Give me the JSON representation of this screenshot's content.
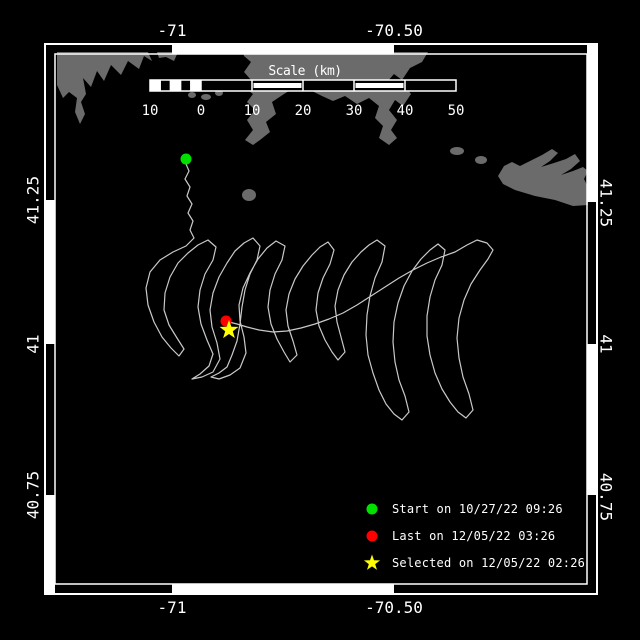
{
  "colors": {
    "background": "#000000",
    "frame": "#ffffff",
    "land": "#6b6b6b",
    "track": "#c9c9c9",
    "text": "#ffffff",
    "start_marker": "#00e100",
    "last_marker": "#ff0000",
    "selected_marker": "#ffff00"
  },
  "axis_labels": {
    "top": [
      {
        "text": "-71",
        "x": 172
      },
      {
        "text": "-70.50",
        "x": 394
      }
    ],
    "bottom": [
      {
        "text": "-71",
        "x": 172
      },
      {
        "text": "-70.50",
        "x": 394
      }
    ],
    "left": [
      {
        "text": "41.25",
        "y": 200
      },
      {
        "text": "41",
        "y": 344
      },
      {
        "text": "40.75",
        "y": 495
      }
    ],
    "right": [
      {
        "text": "41.25",
        "y": 203
      },
      {
        "text": "41",
        "y": 344
      },
      {
        "text": "40.75",
        "y": 497
      }
    ]
  },
  "frame": {
    "outer": [
      45,
      44,
      597,
      594
    ],
    "band": 10,
    "top_fill": [
      [
        172,
        394
      ]
    ],
    "bottom_fill": [
      [
        172,
        394
      ]
    ],
    "left_fill": [
      [
        200,
        344
      ],
      [
        495,
        594
      ]
    ],
    "right_fill": [
      [
        44,
        202
      ],
      [
        344,
        495
      ]
    ]
  },
  "scale_bar": {
    "title": "Scale (km)",
    "title_x": 305,
    "title_y": 64,
    "x0": 150,
    "x1": 456,
    "y": 80,
    "h": 11,
    "zero_x": 201,
    "labels": [
      {
        "text": "10",
        "x": 150
      },
      {
        "text": "0",
        "x": 201
      },
      {
        "text": "10",
        "x": 252
      },
      {
        "text": "20",
        "x": 303
      },
      {
        "text": "30",
        "x": 354
      },
      {
        "text": "40",
        "x": 405
      },
      {
        "text": "50",
        "x": 456
      }
    ],
    "label_y": 103,
    "sub_white": [
      [
        150.0,
        160.2
      ],
      [
        170.4,
        180.6
      ],
      [
        190.8,
        201.0
      ]
    ],
    "seg_edges": [
      160.2,
      170.4,
      180.6,
      190.8,
      201,
      252,
      303,
      354,
      405
    ],
    "filled_inset": [
      [
        252,
        303
      ],
      [
        354,
        405
      ]
    ]
  },
  "legend": {
    "items": [
      {
        "marker": "circle",
        "color": "#00e100",
        "label": "Start on 10/27/22 09:26"
      },
      {
        "marker": "circle",
        "color": "#ff0000",
        "label": "Last on 12/05/22 03:26"
      },
      {
        "marker": "star",
        "color": "#ffff00",
        "label": "Selected on 12/05/22 02:26"
      }
    ]
  },
  "markers": {
    "start": {
      "x": 186,
      "y": 159,
      "r": 5.5
    },
    "last": {
      "x": 226,
      "y": 321,
      "r": 5.5
    },
    "selected": {
      "x": 229,
      "y": 330,
      "R": 10,
      "r": 4
    }
  },
  "map": {
    "land_polygons": [
      [
        [
          57,
          85
        ],
        [
          57,
          52
        ],
        [
          148,
          52
        ],
        [
          152,
          61
        ],
        [
          144,
          56
        ],
        [
          139,
          69
        ],
        [
          128,
          61
        ],
        [
          121,
          75
        ],
        [
          111,
          65
        ],
        [
          104,
          81
        ],
        [
          97,
          71
        ],
        [
          91,
          87
        ],
        [
          83,
          78
        ],
        [
          86,
          94
        ],
        [
          81,
          102
        ],
        [
          85,
          114
        ],
        [
          80,
          124
        ],
        [
          75,
          112
        ],
        [
          77,
          98
        ],
        [
          69,
          92
        ],
        [
          63,
          98
        ]
      ],
      [
        [
          157,
          52
        ],
        [
          178,
          52
        ],
        [
          174,
          61
        ],
        [
          166,
          57
        ],
        [
          159,
          58
        ]
      ],
      [
        [
          243,
          52
        ],
        [
          428,
          52
        ],
        [
          422,
          62
        ],
        [
          410,
          68
        ],
        [
          402,
          80
        ],
        [
          394,
          74
        ],
        [
          387,
          82
        ],
        [
          396,
          90
        ],
        [
          405,
          86
        ],
        [
          411,
          94
        ],
        [
          403,
          106
        ],
        [
          395,
          100
        ],
        [
          389,
          110
        ],
        [
          397,
          120
        ],
        [
          391,
          130
        ],
        [
          397,
          138
        ],
        [
          389,
          145
        ],
        [
          379,
          138
        ],
        [
          383,
          126
        ],
        [
          375,
          118
        ],
        [
          379,
          106
        ],
        [
          369,
          98
        ],
        [
          357,
          104
        ],
        [
          345,
          96
        ],
        [
          333,
          101
        ],
        [
          322,
          96
        ],
        [
          310,
          90
        ],
        [
          297,
          86
        ],
        [
          284,
          94
        ],
        [
          272,
          102
        ],
        [
          276,
          114
        ],
        [
          266,
          122
        ],
        [
          270,
          132
        ],
        [
          260,
          140
        ],
        [
          253,
          145
        ],
        [
          245,
          140
        ],
        [
          253,
          130
        ],
        [
          247,
          120
        ],
        [
          255,
          110
        ],
        [
          247,
          102
        ],
        [
          253,
          94
        ],
        [
          245,
          88
        ],
        [
          251,
          80
        ],
        [
          244,
          72
        ],
        [
          251,
          62
        ],
        [
          244,
          56
        ]
      ],
      [
        [
          498,
          176
        ],
        [
          504,
          166
        ],
        [
          512,
          162
        ],
        [
          520,
          166
        ],
        [
          530,
          161
        ],
        [
          542,
          155
        ],
        [
          552,
          149
        ],
        [
          558,
          153
        ],
        [
          550,
          161
        ],
        [
          541,
          167
        ],
        [
          554,
          163
        ],
        [
          566,
          159
        ],
        [
          575,
          154
        ],
        [
          580,
          161
        ],
        [
          571,
          169
        ],
        [
          561,
          175
        ],
        [
          573,
          171
        ],
        [
          583,
          167
        ],
        [
          588,
          171
        ],
        [
          584,
          179
        ],
        [
          588,
          187
        ],
        [
          588,
          205
        ],
        [
          573,
          206
        ],
        [
          555,
          200
        ],
        [
          535,
          196
        ],
        [
          515,
          190
        ],
        [
          503,
          184
        ]
      ]
    ],
    "land_ellipses": [
      [
        192,
        95,
        4,
        3
      ],
      [
        206,
        97,
        5,
        3
      ],
      [
        219,
        93,
        4,
        3
      ],
      [
        228,
        83,
        3,
        3
      ],
      [
        249,
        195,
        7,
        6
      ],
      [
        457,
        151,
        7,
        4
      ],
      [
        481,
        160,
        6,
        4
      ]
    ],
    "track": [
      [
        186,
        164
      ],
      [
        189,
        171
      ],
      [
        185,
        179
      ],
      [
        190,
        187
      ],
      [
        187,
        196
      ],
      [
        192,
        204
      ],
      [
        188,
        213
      ],
      [
        193,
        221
      ],
      [
        190,
        230
      ],
      [
        194,
        238
      ],
      [
        186,
        246
      ],
      [
        173,
        252
      ],
      [
        160,
        260
      ],
      [
        150,
        272
      ],
      [
        146,
        288
      ],
      [
        148,
        305
      ],
      [
        154,
        322
      ],
      [
        162,
        337
      ],
      [
        171,
        348
      ],
      [
        179,
        356
      ],
      [
        184,
        349
      ],
      [
        177,
        338
      ],
      [
        169,
        325
      ],
      [
        164,
        310
      ],
      [
        165,
        293
      ],
      [
        170,
        277
      ],
      [
        178,
        263
      ],
      [
        188,
        253
      ],
      [
        198,
        245
      ],
      [
        208,
        240
      ],
      [
        216,
        247
      ],
      [
        213,
        260
      ],
      [
        205,
        274
      ],
      [
        200,
        290
      ],
      [
        198,
        307
      ],
      [
        201,
        324
      ],
      [
        207,
        340
      ],
      [
        213,
        354
      ],
      [
        209,
        366
      ],
      [
        200,
        374
      ],
      [
        192,
        379
      ],
      [
        202,
        377
      ],
      [
        213,
        372
      ],
      [
        220,
        359
      ],
      [
        217,
        343
      ],
      [
        212,
        327
      ],
      [
        210,
        310
      ],
      [
        213,
        293
      ],
      [
        219,
        277
      ],
      [
        227,
        263
      ],
      [
        235,
        251
      ],
      [
        244,
        243
      ],
      [
        253,
        238
      ],
      [
        260,
        246
      ],
      [
        257,
        260
      ],
      [
        250,
        274
      ],
      [
        245,
        290
      ],
      [
        242,
        307
      ],
      [
        240,
        324
      ],
      [
        237,
        341
      ],
      [
        232,
        355
      ],
      [
        227,
        367
      ],
      [
        219,
        373
      ],
      [
        211,
        377
      ],
      [
        219,
        379
      ],
      [
        230,
        375
      ],
      [
        240,
        368
      ],
      [
        246,
        353
      ],
      [
        244,
        337
      ],
      [
        240,
        321
      ],
      [
        239,
        305
      ],
      [
        243,
        288
      ],
      [
        250,
        273
      ],
      [
        258,
        259
      ],
      [
        267,
        248
      ],
      [
        276,
        241
      ],
      [
        285,
        246
      ],
      [
        282,
        260
      ],
      [
        275,
        274
      ],
      [
        270,
        290
      ],
      [
        268,
        307
      ],
      [
        271,
        324
      ],
      [
        277,
        339
      ],
      [
        284,
        352
      ],
      [
        290,
        362
      ],
      [
        297,
        355
      ],
      [
        293,
        341
      ],
      [
        288,
        326
      ],
      [
        286,
        310
      ],
      [
        289,
        294
      ],
      [
        295,
        279
      ],
      [
        303,
        266
      ],
      [
        312,
        255
      ],
      [
        320,
        247
      ],
      [
        328,
        242
      ],
      [
        334,
        250
      ],
      [
        330,
        264
      ],
      [
        323,
        278
      ],
      [
        318,
        293
      ],
      [
        316,
        310
      ],
      [
        319,
        326
      ],
      [
        325,
        340
      ],
      [
        332,
        352
      ],
      [
        338,
        360
      ],
      [
        345,
        352
      ],
      [
        341,
        337
      ],
      [
        337,
        322
      ],
      [
        335,
        306
      ],
      [
        338,
        290
      ],
      [
        344,
        275
      ],
      [
        352,
        262
      ],
      [
        361,
        252
      ],
      [
        369,
        245
      ],
      [
        377,
        240
      ],
      [
        385,
        246
      ],
      [
        382,
        262
      ],
      [
        375,
        278
      ],
      [
        370,
        296
      ],
      [
        367,
        315
      ],
      [
        366,
        335
      ],
      [
        368,
        355
      ],
      [
        373,
        373
      ],
      [
        379,
        390
      ],
      [
        386,
        404
      ],
      [
        394,
        414
      ],
      [
        402,
        420
      ],
      [
        409,
        412
      ],
      [
        405,
        396
      ],
      [
        399,
        380
      ],
      [
        395,
        362
      ],
      [
        393,
        342
      ],
      [
        394,
        322
      ],
      [
        398,
        303
      ],
      [
        404,
        286
      ],
      [
        412,
        271
      ],
      [
        421,
        259
      ],
      [
        430,
        250
      ],
      [
        438,
        244
      ],
      [
        445,
        250
      ],
      [
        442,
        265
      ],
      [
        435,
        280
      ],
      [
        430,
        297
      ],
      [
        427,
        316
      ],
      [
        427,
        336
      ],
      [
        430,
        355
      ],
      [
        435,
        373
      ],
      [
        442,
        389
      ],
      [
        450,
        402
      ],
      [
        458,
        412
      ],
      [
        466,
        418
      ],
      [
        473,
        410
      ],
      [
        469,
        394
      ],
      [
        463,
        377
      ],
      [
        459,
        358
      ],
      [
        457,
        338
      ],
      [
        459,
        318
      ],
      [
        464,
        300
      ],
      [
        471,
        284
      ],
      [
        480,
        270
      ],
      [
        488,
        259
      ],
      [
        493,
        250
      ],
      [
        487,
        243
      ],
      [
        477,
        240
      ],
      [
        467,
        245
      ],
      [
        455,
        252
      ],
      [
        441,
        257
      ],
      [
        427,
        263
      ],
      [
        413,
        270
      ],
      [
        399,
        278
      ],
      [
        385,
        287
      ],
      [
        371,
        296
      ],
      [
        357,
        305
      ],
      [
        343,
        313
      ],
      [
        329,
        319
      ],
      [
        315,
        324
      ],
      [
        301,
        328
      ],
      [
        287,
        331
      ],
      [
        273,
        332
      ],
      [
        259,
        330
      ],
      [
        247,
        327
      ],
      [
        237,
        324
      ],
      [
        229,
        322
      ]
    ]
  }
}
